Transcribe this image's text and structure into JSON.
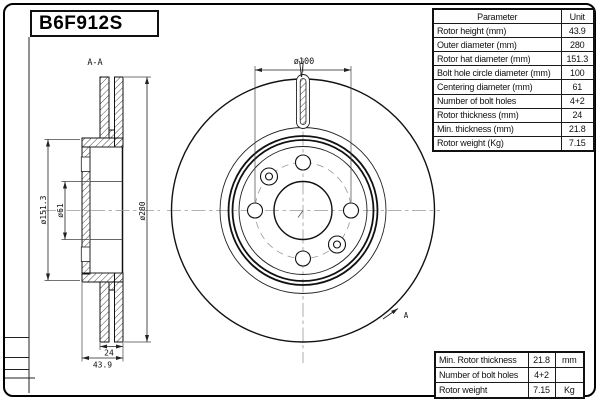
{
  "part_box": {
    "part_number": "B6F912S"
  },
  "drawing": {
    "section_view_label": "A-A",
    "section_arrow_label": "A",
    "dim_bolt_circle": "ø100",
    "dim_outer_diameter": "ø280",
    "dim_hat_diameter": "ø151.3",
    "dim_centering_diameter": "ø61",
    "dim_thickness": "24",
    "dim_height": "43.9"
  },
  "spec_table": {
    "header_parameter": "Parameter",
    "header_unit": "Unit",
    "rows": [
      {
        "name": "Rotor height (mm)",
        "value": "43.9"
      },
      {
        "name": "Outer diameter (mm)",
        "value": "280"
      },
      {
        "name": "Rotor hat diameter (mm)",
        "value": "151.3"
      },
      {
        "name": "Bolt hole circle diameter (mm)",
        "value": "100"
      },
      {
        "name": "Centering diameter (mm)",
        "value": "61"
      },
      {
        "name": "Number of bolt holes",
        "value": "4+2"
      },
      {
        "name": "Rotor thickness (mm)",
        "value": "24"
      },
      {
        "name": "Min. thickness (mm)",
        "value": "21.8"
      },
      {
        "name": "Rotor weight (Kg)",
        "value": "7.15"
      }
    ]
  },
  "summary_table": {
    "rows": [
      {
        "name": "Min. Rotor thickness",
        "value": "21.8",
        "unit": "mm"
      },
      {
        "name": "Number of bolt holes",
        "value": "4+2",
        "unit": ""
      },
      {
        "name": "Rotor weight",
        "value": "7.15",
        "unit": "Kg"
      }
    ]
  }
}
